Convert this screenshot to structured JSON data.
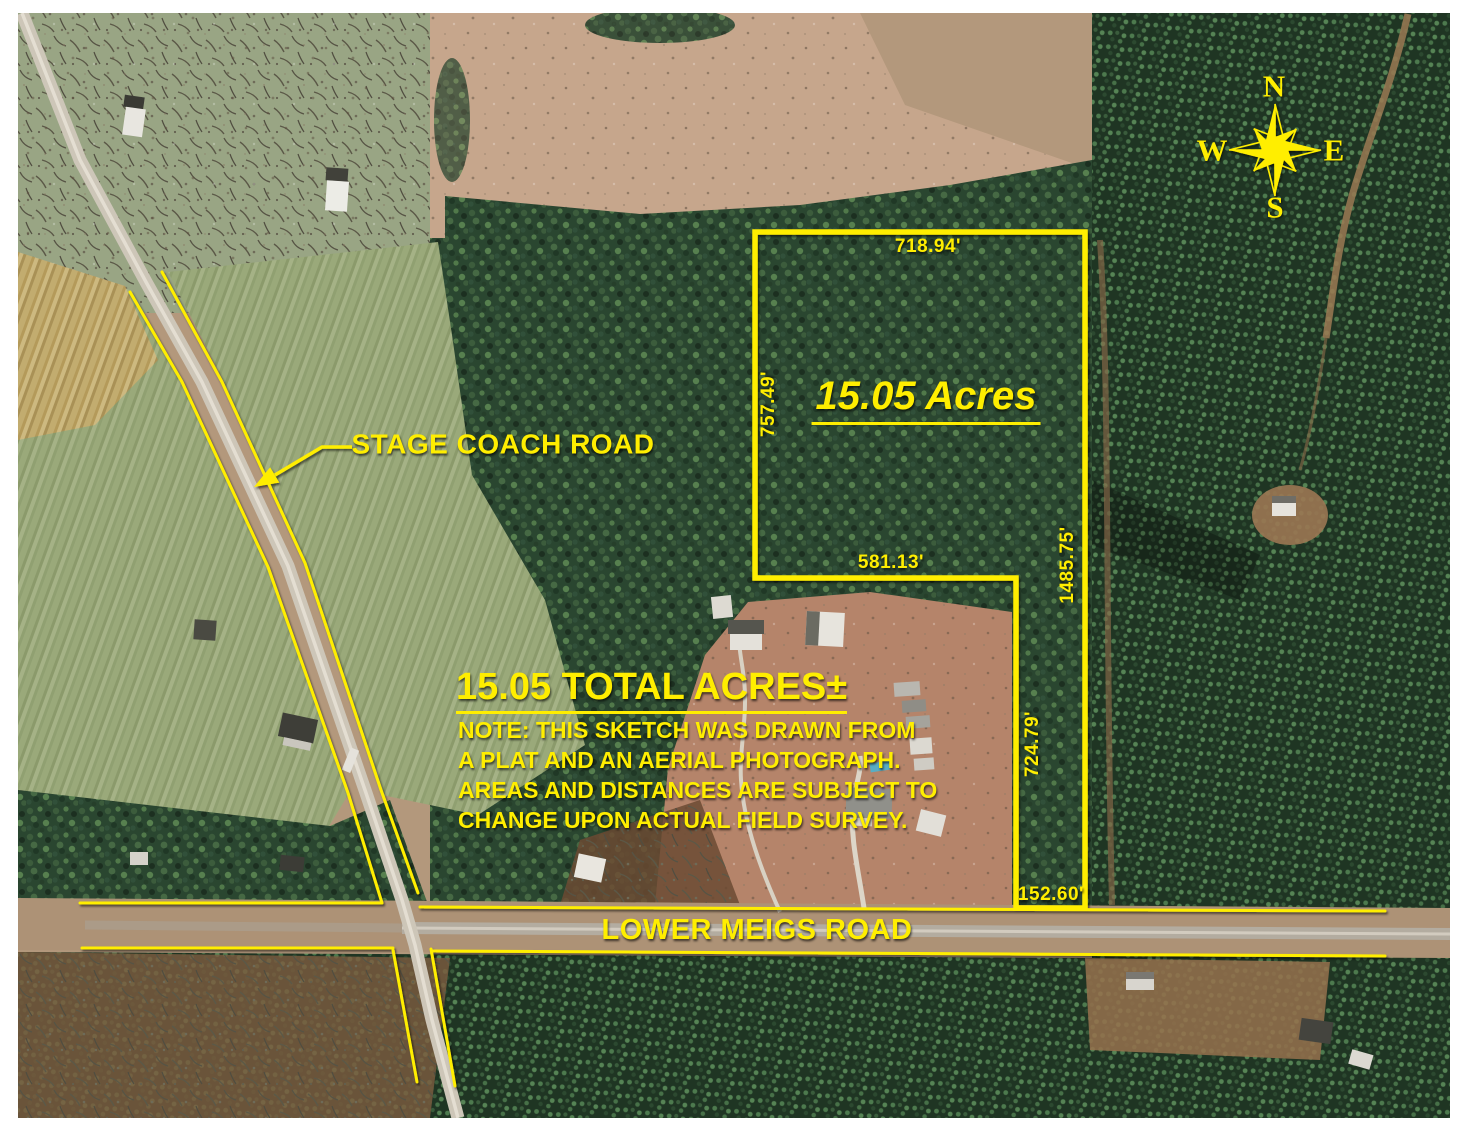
{
  "parcel": {
    "area_label": "15.05 Acres",
    "total_label": "15.05 TOTAL ACRES±",
    "dimensions": {
      "north": "718.94'",
      "west": "757.49'",
      "inner_south": "581.13'",
      "east": "1485.75'",
      "inner_west": "724.79'",
      "south": "152.60'"
    }
  },
  "roads": [
    {
      "name": "STAGE COACH ROAD"
    },
    {
      "name": "LOWER MEIGS ROAD"
    }
  ],
  "note": {
    "line1": "NOTE: THIS SKETCH WAS DRAWN FROM",
    "line2": "A PLAT AND AN AERIAL PHOTOGRAPH.",
    "line3": "AREAS AND DISTANCES ARE SUBJECT TO",
    "line4": "CHANGE UPON ACTUAL FIELD SURVEY."
  },
  "compass": {
    "north": "N",
    "east": "E",
    "south": "S",
    "west": "W"
  },
  "colors": {
    "annotation_yellow": "#ffee00",
    "forest_green": "#2a4630",
    "pine_rows_green": "#1e3423",
    "field_green": "#98a777",
    "pasture_tan": "#c6a68c",
    "road_gray": "#cdc6b8"
  }
}
